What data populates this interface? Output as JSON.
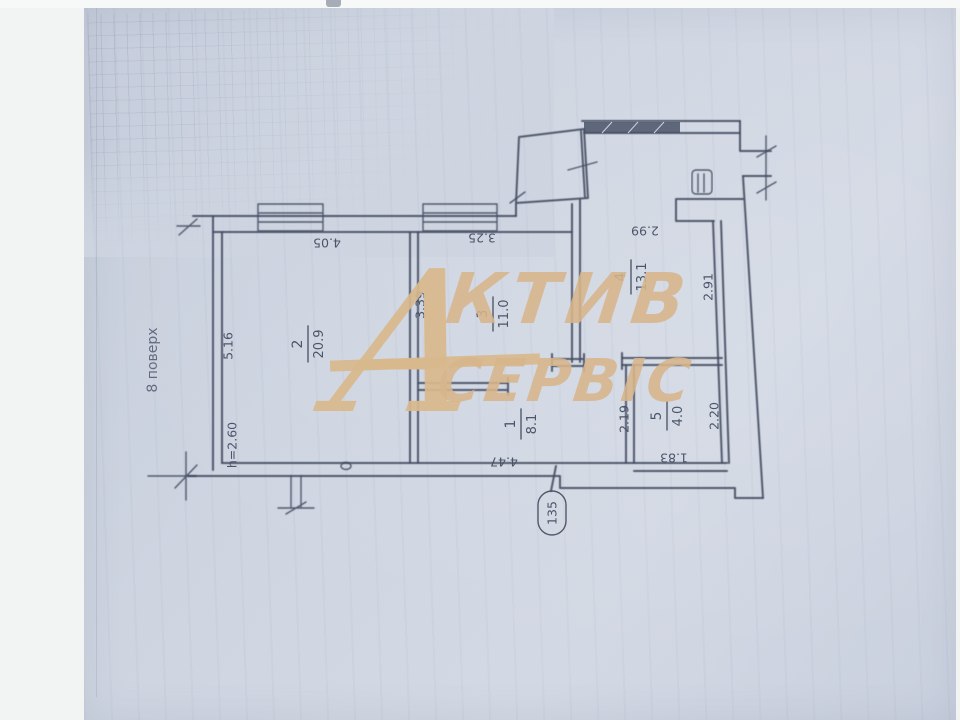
{
  "watermark": {
    "initial": "А",
    "line1": "КТИВ",
    "line2": "СЕРВІС",
    "color": "#d7b58a"
  },
  "annotations": {
    "floor": "8 поверх",
    "apartment_number": "135",
    "ceiling_height": "h=2.60"
  },
  "rooms": [
    {
      "number": "2",
      "area": "20.9"
    },
    {
      "number": "3",
      "area": "11.0"
    },
    {
      "number": "4",
      "area": "13.1"
    },
    {
      "number": "1",
      "area": "8.1"
    },
    {
      "number": "5",
      "area": "4.0"
    }
  ],
  "dimensions": {
    "room2_top": "4.05",
    "room3_top": "3.25",
    "room4_top": "2.99",
    "room2_left": "5.16",
    "room3_left": "3.39",
    "room4_right": "2.91",
    "room1_bottom": "4.47",
    "room1_right": "2.19",
    "room5_right": "2.20",
    "room5_bottom": "1.83"
  },
  "colors": {
    "ink": "#454e63",
    "paper": "#ced5e1",
    "watermark": "#d7b58a"
  }
}
